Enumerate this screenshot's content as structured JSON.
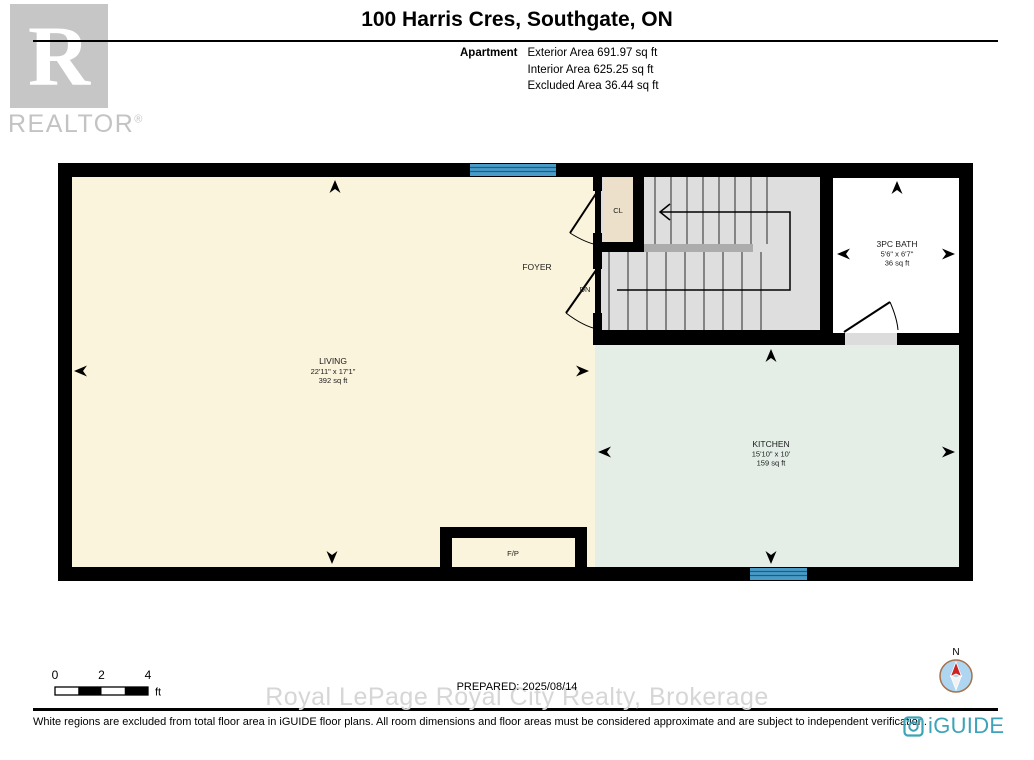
{
  "header": {
    "title": "100 Harris Cres, Southgate, ON",
    "realtor": {
      "letter": "R",
      "wordmark": "REALTOR",
      "reg": "®"
    },
    "unit_type": "Apartment",
    "area_lines": [
      "Exterior Area 691.97 sq ft",
      "Interior Area 625.25 sq ft",
      "Excluded Area 36.44 sq ft"
    ]
  },
  "plan": {
    "rooms": {
      "living": {
        "name": "LIVING",
        "dims": "22'11\" x 17'1\"",
        "area": "392 sq ft"
      },
      "kitchen": {
        "name": "KITCHEN",
        "dims": "15'10\" x 10'",
        "area": "159 sq ft"
      },
      "bath": {
        "name": "3PC BATH",
        "dims": "5'6\" x 6'7\"",
        "area": "36 sq ft"
      },
      "foyer": {
        "name": "FOYER"
      }
    },
    "labels": {
      "closet": "CL",
      "down": "DN",
      "fireplace": "F/P"
    },
    "colors": {
      "wall": "#000000",
      "living": "#fbf4dc",
      "kitchen": "#e4eee7",
      "stairs": "#dedede",
      "stair_landing": "#acacac",
      "closet": "#ede0cb",
      "bath": "#ffffff",
      "window": "#4a9cc8",
      "window_stripe": "#1b5e8c",
      "door_landing": "#dcdcdc",
      "compass_face": "#aed6f1",
      "compass_ring": "#a4724e",
      "compass_north": "#cc2222",
      "brand_teal": "#3fa3b8"
    }
  },
  "footer": {
    "scale_ticks": [
      "0",
      "2",
      "4"
    ],
    "scale_unit": "ft",
    "prepared": "PREPARED: 2025/08/14",
    "watermark": "Royal LePage Royal City Realty, Brokerage",
    "compass_north_label": "N",
    "brand": "iGUIDE",
    "disclaimer": "White regions are excluded from total floor area in iGUIDE floor plans. All room dimensions and floor areas must be considered approximate and are subject to independent verification."
  }
}
